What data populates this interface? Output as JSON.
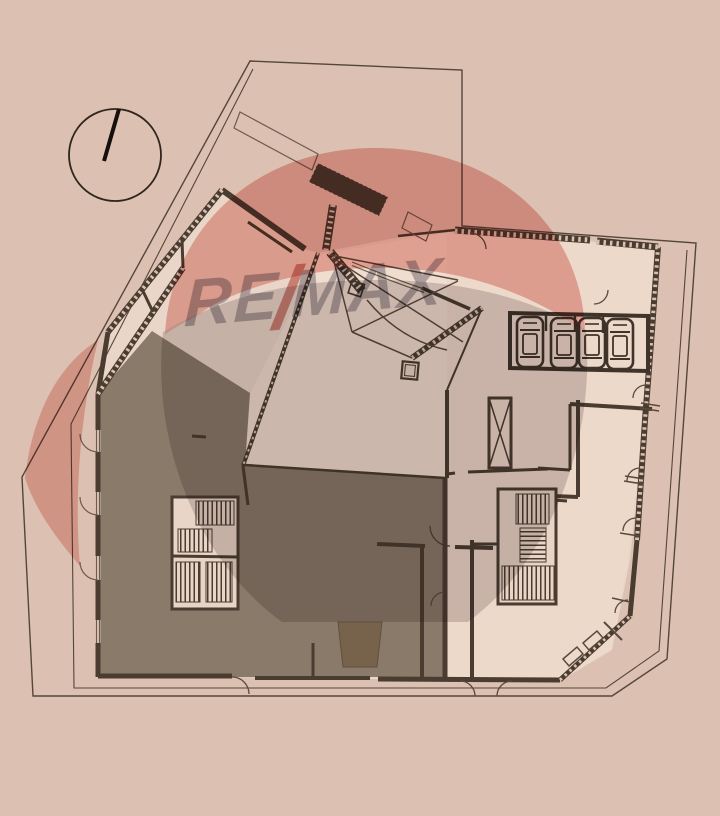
{
  "document": {
    "type": "architectural-floor-plan",
    "watermark": {
      "part1": "RE",
      "slash": "/",
      "part2": "MAX"
    },
    "compass": {
      "style": "circle-with-north-needle"
    },
    "parking": {
      "car_count": 4
    },
    "highlighted_unit": {
      "present": true
    },
    "colors": {
      "background": "#dcc0b2",
      "building_floor": "#e9d6c8",
      "hall_floor": "#efddcf",
      "walls": "#4a3c30",
      "boundary_line": "#54463a",
      "highlighted_unit_fill": "#897a6a",
      "stair_fill": "#e8d5c7",
      "watermark_balloon_pink": "#e89e95",
      "watermark_balloon_gray": "#b3a7a9",
      "watermark_basket": "#d9c6a6",
      "watermark_text_gray": "#8e8a97",
      "watermark_slash_red": "#c4574c"
    }
  }
}
